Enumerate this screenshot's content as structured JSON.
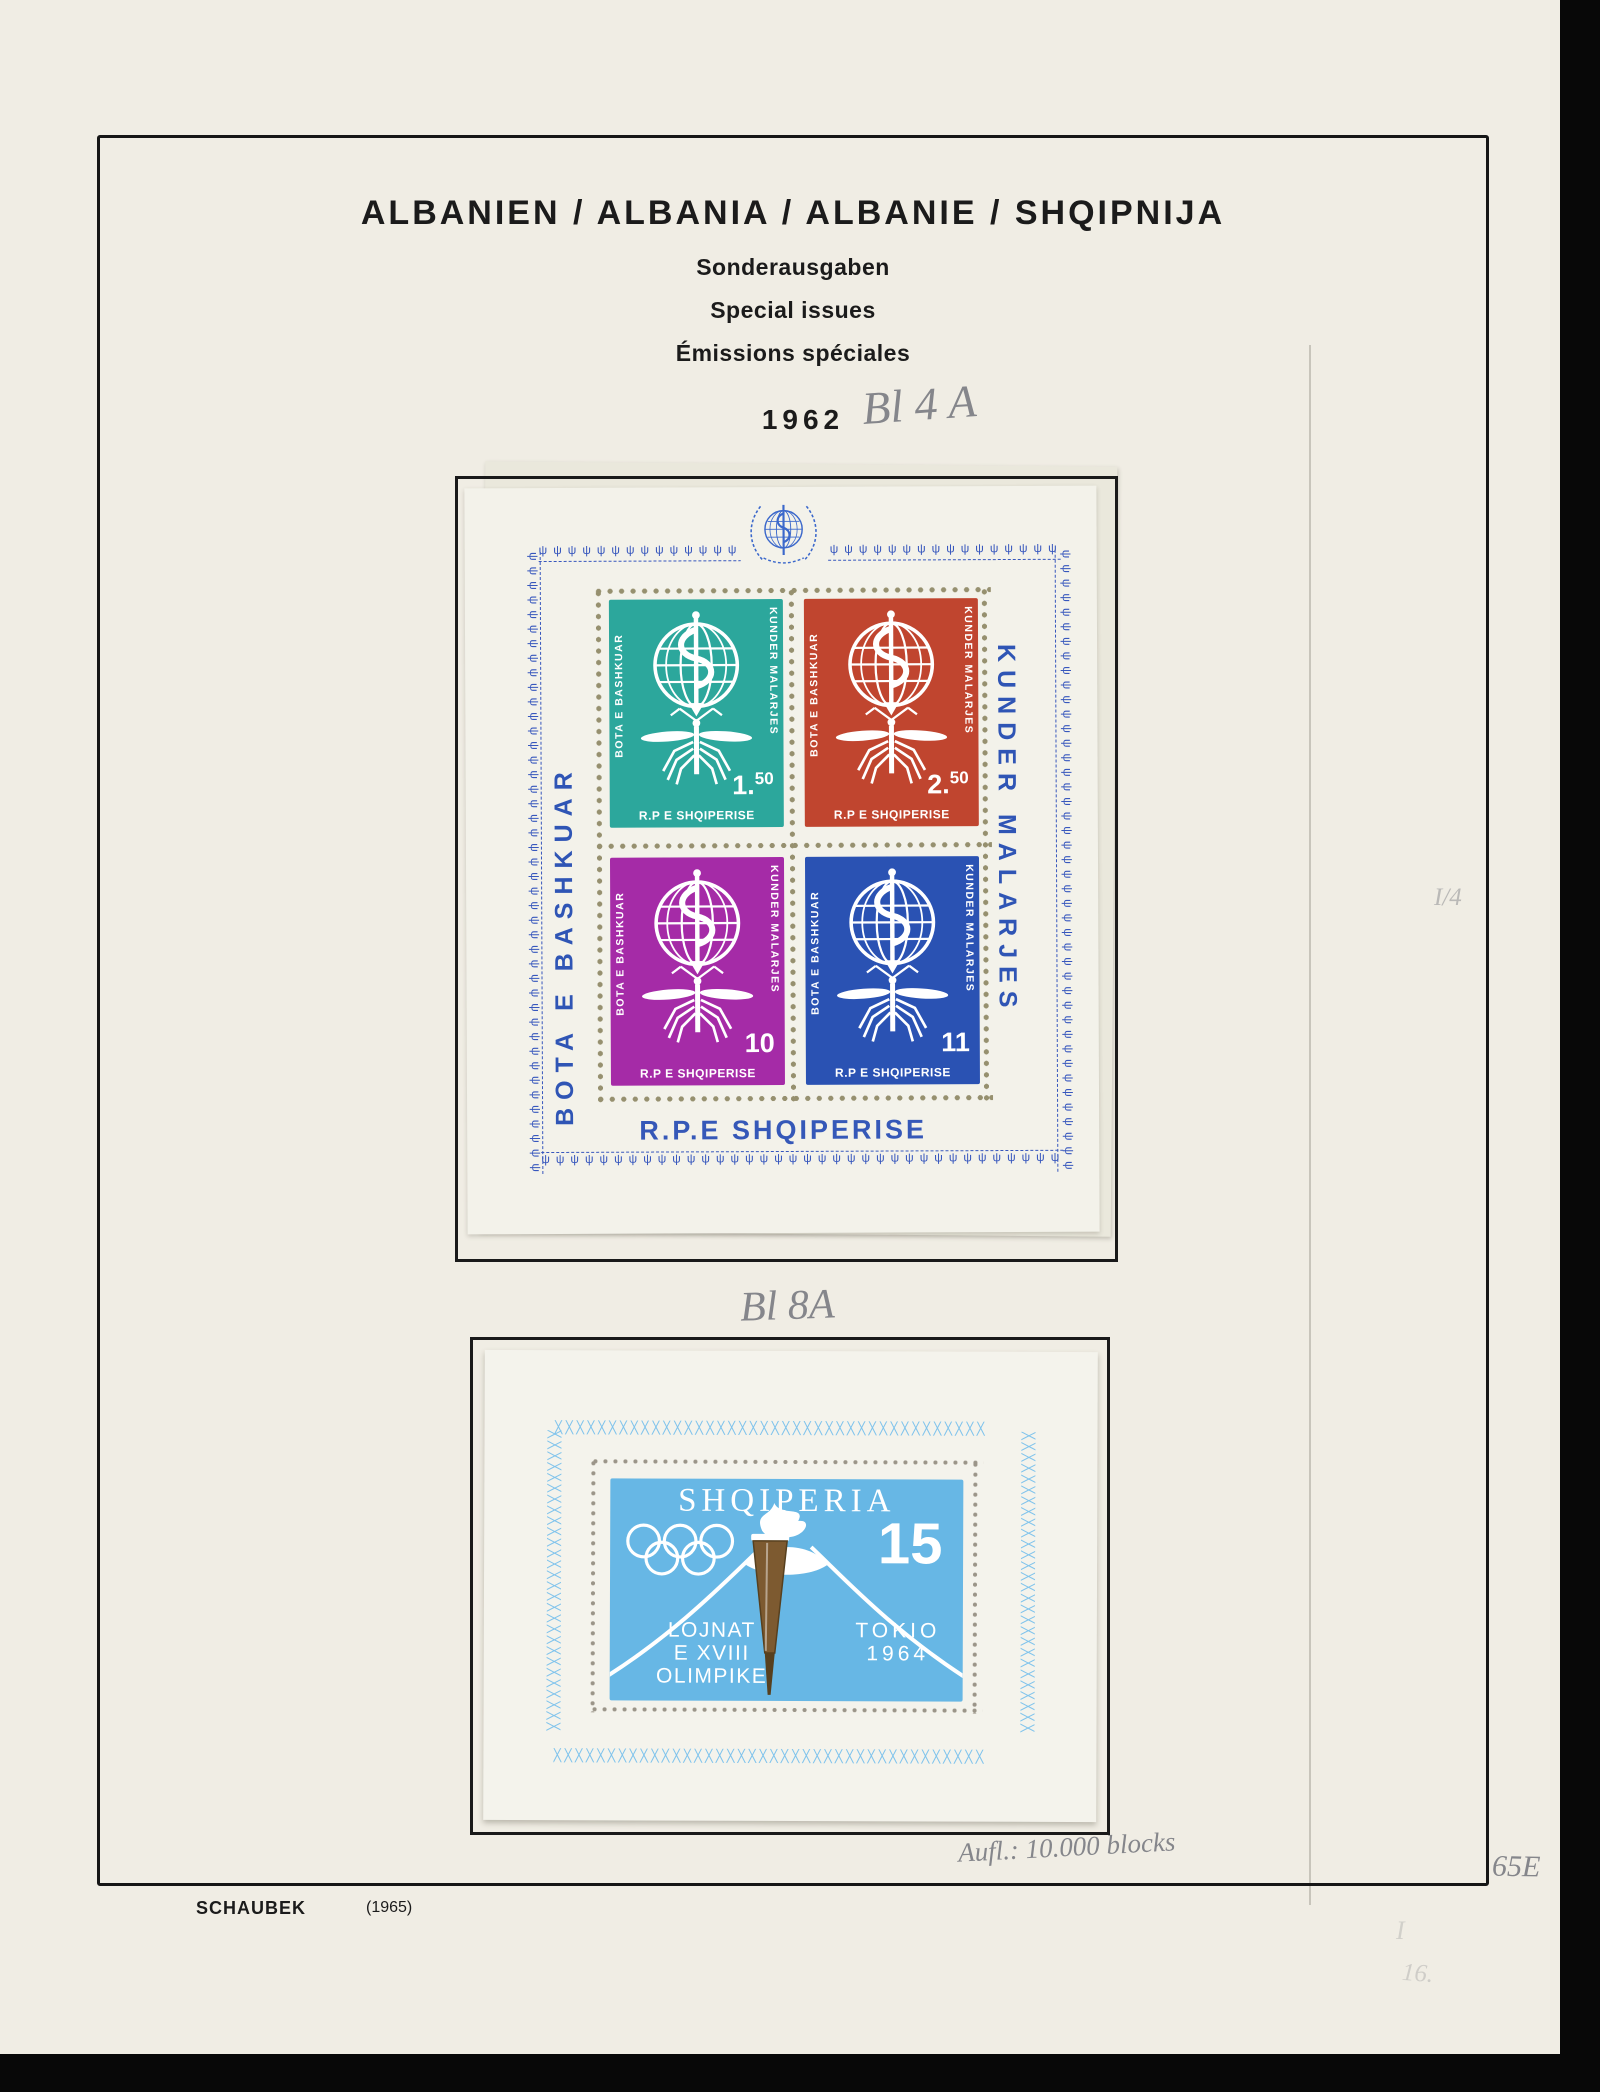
{
  "header": {
    "country_line": "ALBANIEN / ALBANIA / ALBANIE / SHQIPNIJA",
    "subtitle_de": "Sonderausgaben",
    "subtitle_en": "Special issues",
    "subtitle_fr": "Émissions spéciales",
    "year": "1962"
  },
  "handwriting": {
    "block1_note": "Bl 4 A",
    "block2_note": "Bl 8A",
    "print_run_note": "Aufl.: 10.000 blocks",
    "corner_code": "65E",
    "margin_mark": "I/4",
    "bottom_mark_1": "I",
    "bottom_mark_2": "16."
  },
  "sheet1": {
    "margin_left_text": "BOTA E BASHKUAR",
    "margin_right_text": "KUNDER MALARJES",
    "bottom_text": "R.P.E SHQIPERISE",
    "ornament_glyph": "ψ",
    "ornament_color": "#3757bd",
    "dot_color": "#96906f",
    "stamps": [
      {
        "side_left": "BOTA E BASHKUAR",
        "side_right": "KUNDER MALARJES",
        "value_main": "1.",
        "value_sup": "50",
        "bottom": "R.P E SHQIPERISE",
        "color": "#2ca79c"
      },
      {
        "side_left": "BOTA E BASHKUAR",
        "side_right": "KUNDER MALARJES",
        "value_main": "2.",
        "value_sup": "50",
        "bottom": "R.P E SHQIPERISE",
        "color": "#c0452f"
      },
      {
        "side_left": "BOTA E BASHKUAR",
        "side_right": "KUNDER MALARJES",
        "value_main": "10",
        "value_sup": "",
        "bottom": "R.P E SHQIPERISE",
        "color": "#a52ba7"
      },
      {
        "side_left": "BOTA E BASHKUAR",
        "side_right": "KUNDER MALARJES",
        "value_main": "11",
        "value_sup": "",
        "bottom": "R.P E SHQIPERISE",
        "color": "#2a52b3"
      }
    ]
  },
  "sheet2": {
    "ornament_glyph": "╳",
    "ornament_color": "#7fc3ec",
    "dot_color": "#9b9589",
    "stamp": {
      "country": "SHQIPERIA",
      "value": "15",
      "line1": "LOJNAT",
      "line2": "E XVIII",
      "line3": "OLIMPIKE",
      "right1": "TOKIO",
      "right2": "1964",
      "color": "#67b7e5",
      "torch_color": "#7d5a30"
    }
  },
  "footer": {
    "publisher": "SCHAUBEK",
    "edition": "(1965)"
  }
}
